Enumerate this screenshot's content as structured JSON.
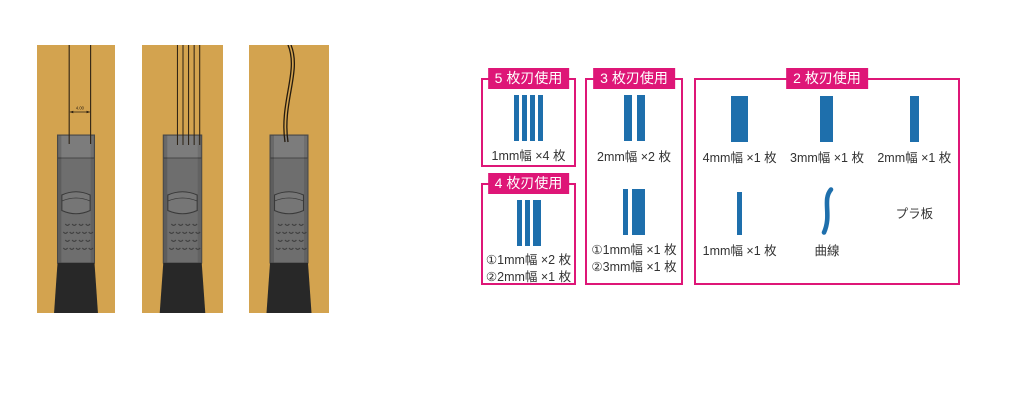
{
  "colors": {
    "accent": "#de1677",
    "blade_blue": "#1e6fac",
    "board_tan": "#d3a34f"
  },
  "illustration": {
    "dimension_label": "4.00"
  },
  "boxes": {
    "five": {
      "title": "5 枚刃使用",
      "label": "1mm幅 ×4 枚"
    },
    "four": {
      "title": "4 枚刃使用",
      "labels": [
        "①1mm幅 ×2 枚",
        "②2mm幅 ×1 枚"
      ]
    },
    "three": {
      "title": "3 枚刃使用",
      "top_label": "2mm幅 ×2 枚",
      "bottom_labels": [
        "①1mm幅 ×1 枚",
        "②3mm幅 ×1 枚"
      ]
    },
    "two": {
      "title": "2 枚刃使用",
      "cells": [
        {
          "label": "4mm幅 ×1 枚"
        },
        {
          "label": "3mm幅 ×1 枚"
        },
        {
          "label": "2mm幅 ×1 枚"
        },
        {
          "label": "1mm幅 ×1 枚"
        },
        {
          "label": "曲線"
        },
        {
          "label": "プラ板"
        }
      ]
    }
  }
}
